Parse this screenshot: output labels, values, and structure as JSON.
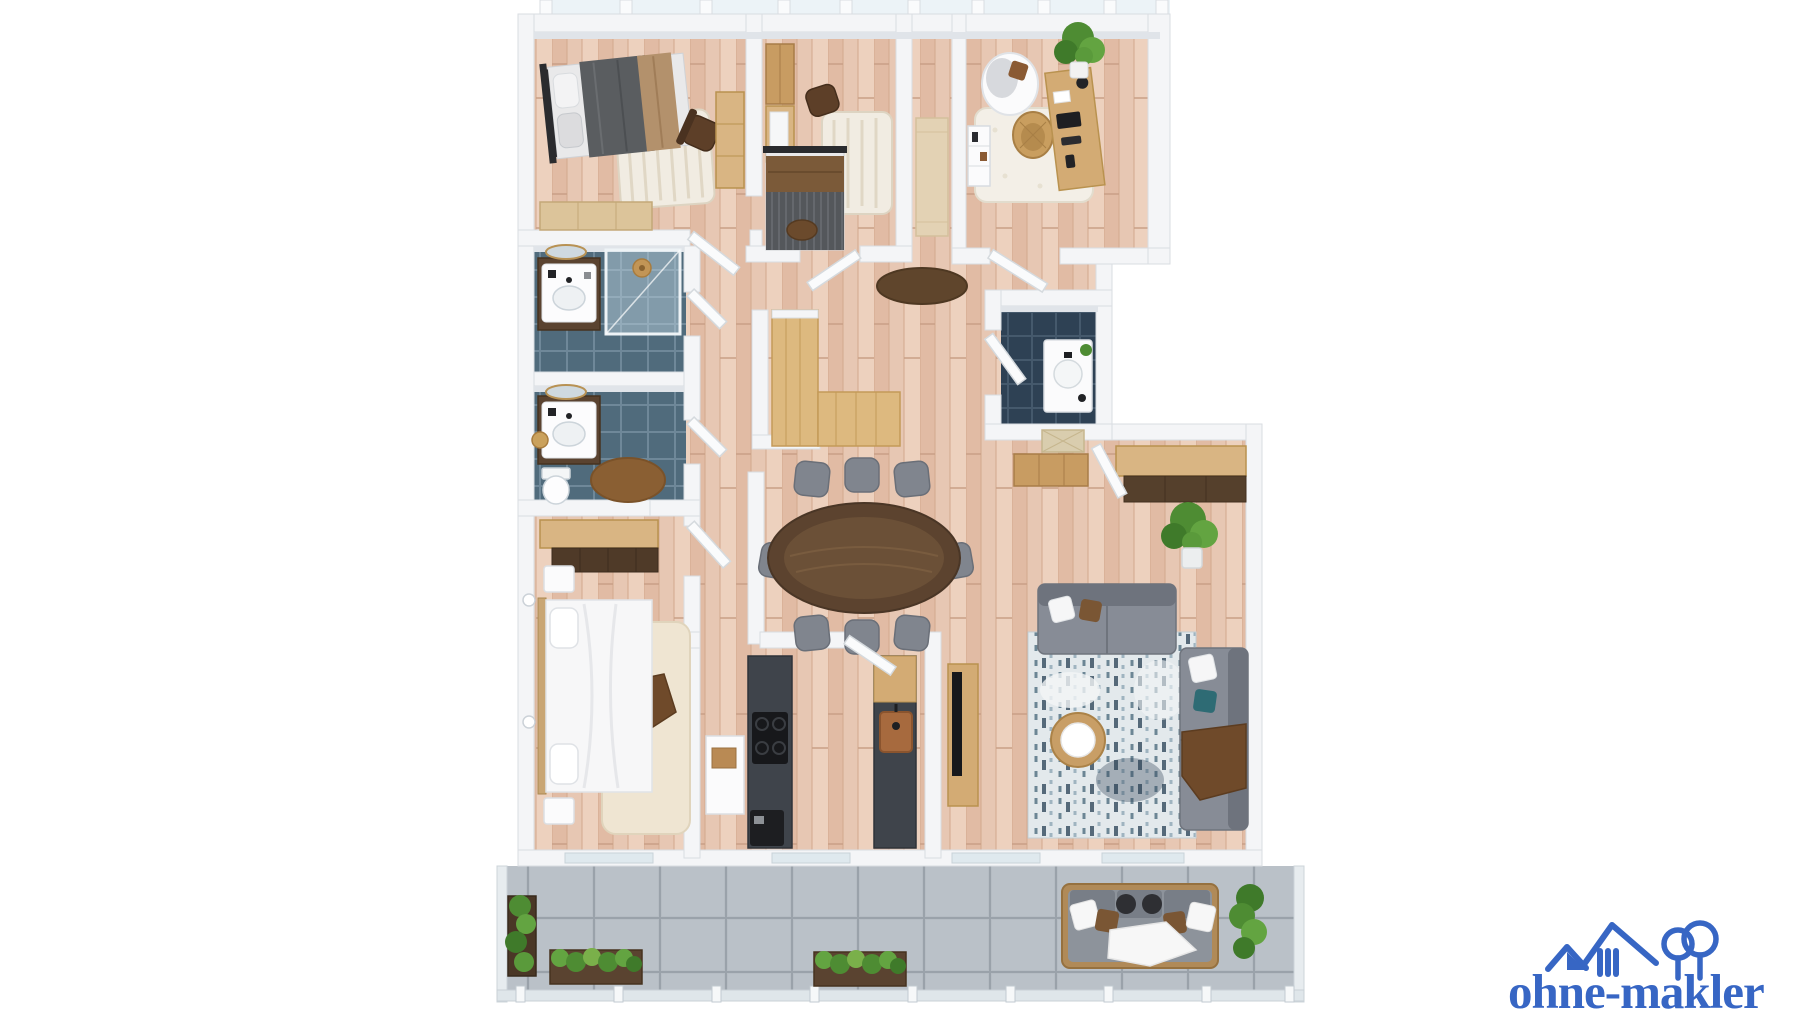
{
  "watermark": {
    "brand_text": "ohne-makler",
    "brand_color": "#3766c4",
    "icons": [
      "house-icon",
      "small-house-icon",
      "trees-icon"
    ]
  },
  "palette": {
    "background": "#ffffff",
    "wall": "#f4f5f7",
    "wall_edge": "#d9dde2",
    "wood_floor": "#e7c7b3",
    "bathroom_tile": "#506b7c",
    "dark_bathroom_tile": "#2e4154",
    "terrace_concrete": "#b5bcc3",
    "light_wood_furniture": "#d9b583",
    "dark_wood_table": "#5c432f",
    "charcoal_counter": "#3f444b",
    "sofa_gray": "#878c96",
    "plant_green": "#4e8c33",
    "rug_cream": "#f1ece2",
    "accent_teal": "#2e6b74",
    "blanket_tan": "#b3916c",
    "blanket_brown": "#6f4a2a",
    "glass_blue": "#dfe9ee"
  },
  "scene": {
    "type": "3d-floor-plan-render",
    "rooms": [
      "bedroom-1",
      "bedroom-2",
      "home-office",
      "bathroom-1",
      "bathroom-2",
      "guest-bathroom",
      "hallway",
      "dining-area",
      "kitchen",
      "living-room",
      "master-bedroom",
      "terrace"
    ]
  }
}
